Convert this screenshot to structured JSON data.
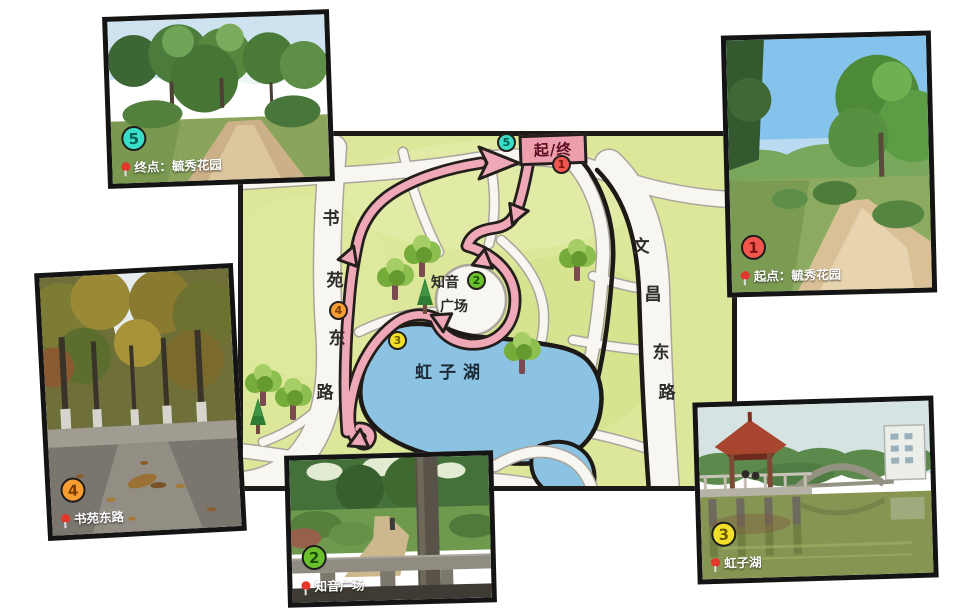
{
  "map": {
    "banner_label": "起/终",
    "left_road_chars": [
      "书",
      "苑",
      "东",
      "路"
    ],
    "right_road_chars": [
      "文",
      "昌",
      "东",
      "路"
    ],
    "plaza_label_line1": "知音",
    "plaza_label_line2": "广场",
    "lake_label": "虹子湖",
    "markers": {
      "start": "1",
      "plaza": "2",
      "lake": "3",
      "road": "4",
      "end": "5"
    }
  },
  "photos": {
    "end": {
      "marker": "5",
      "label": "终点：毓秀花园"
    },
    "start": {
      "marker": "1",
      "label": "起点：毓秀花园"
    },
    "road": {
      "marker": "4",
      "label": "书苑东路"
    },
    "plaza": {
      "marker": "2",
      "label": "知音广场"
    },
    "lake": {
      "marker": "3",
      "label": "虹子湖"
    }
  },
  "colors": {
    "map_background": "#dce79a",
    "road_white": "#f8f6f0",
    "ink_black": "#1d1916",
    "route_pink": "#efa8b6",
    "lake_blue": "#8cc3e2",
    "banner_pink": "#ee9fae",
    "marker_1": "#f0564e",
    "marker_2": "#6cc02e",
    "marker_3": "#f2df2a",
    "marker_4": "#f79d31",
    "marker_5": "#3addc7"
  }
}
